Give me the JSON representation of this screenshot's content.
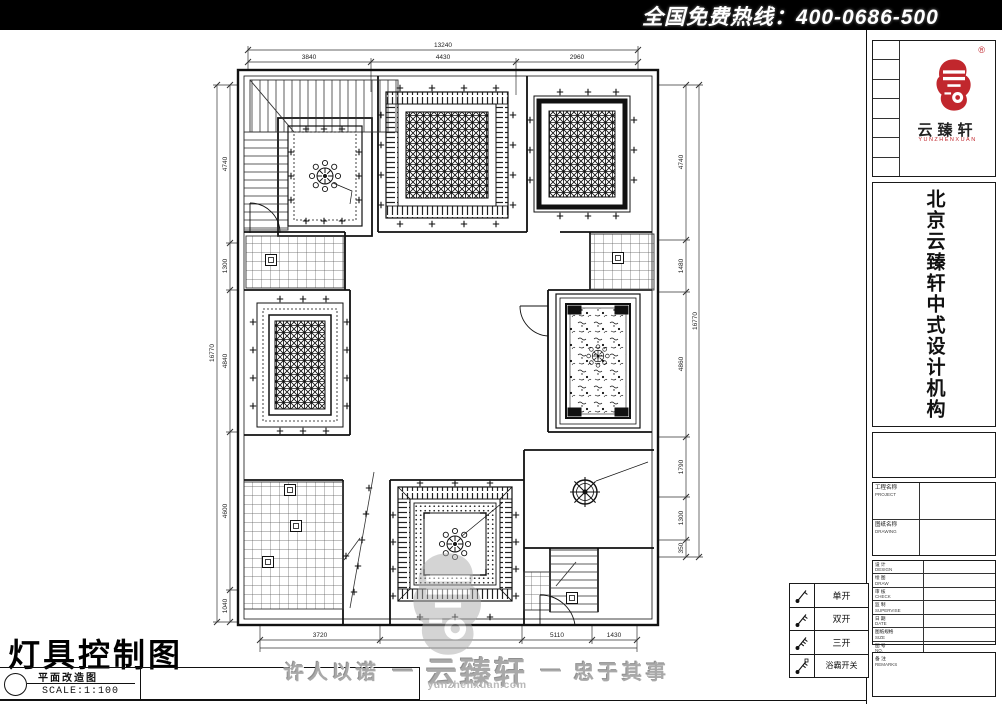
{
  "topbar": {
    "hotline": "全国免费热线：400-0686-500"
  },
  "sidebar": {
    "logo": {
      "reg": "®",
      "name": "云臻轩",
      "romanized": "YUNZHENXUAN"
    },
    "vertical_title": "北京云臻轩中式设计机构",
    "titleblock": {
      "project_label": "工程名称",
      "project_sub": "PROJECT",
      "drawing_label": "图纸名称",
      "drawing_sub": "DRAWING",
      "rows": [
        {
          "label": "设 计",
          "sub": "DESIGN"
        },
        {
          "label": "绘 图",
          "sub": "DRAW"
        },
        {
          "label": "审 核",
          "sub": "CHECK"
        },
        {
          "label": "监 制",
          "sub": "SUPERVISE"
        },
        {
          "label": "日 期",
          "sub": "DATE"
        },
        {
          "label": "图纸规格",
          "sub": "SIZE"
        },
        {
          "label": "图 号",
          "sub": "NO."
        }
      ],
      "note_label": "备 注",
      "note_sub": "REMARKS"
    }
  },
  "legend": {
    "rows": [
      {
        "label": "单开"
      },
      {
        "label": "双开"
      },
      {
        "label": "三开"
      },
      {
        "label": "浴霸开关"
      }
    ]
  },
  "footer": {
    "sheet_title": "灯具控制图",
    "plan_type": "平面改造图",
    "scale": "SCALE:1:100",
    "slogan_left": "许人以诺",
    "dash": "—",
    "brand": "云臻轩",
    "website": "yunzhenxuan.com",
    "slogan_right": "忠于其事"
  },
  "dimensions": {
    "top": {
      "overall": "13240",
      "segments": [
        "3840",
        "4430",
        "2960"
      ]
    },
    "left": {
      "overall": "16770",
      "segments": [
        "4740",
        "1300",
        "4840",
        "4600",
        "1040"
      ]
    },
    "right": {
      "overall": "16770",
      "segments": [
        "4740",
        "1480",
        "4860",
        "1790",
        "1300",
        "350"
      ]
    },
    "bottom": {
      "segments": [
        "3720",
        "5110",
        "1430"
      ]
    }
  },
  "colors": {
    "brand_red": "#c1272d",
    "ink": "#111111",
    "watermark_gray": "#ababab"
  }
}
